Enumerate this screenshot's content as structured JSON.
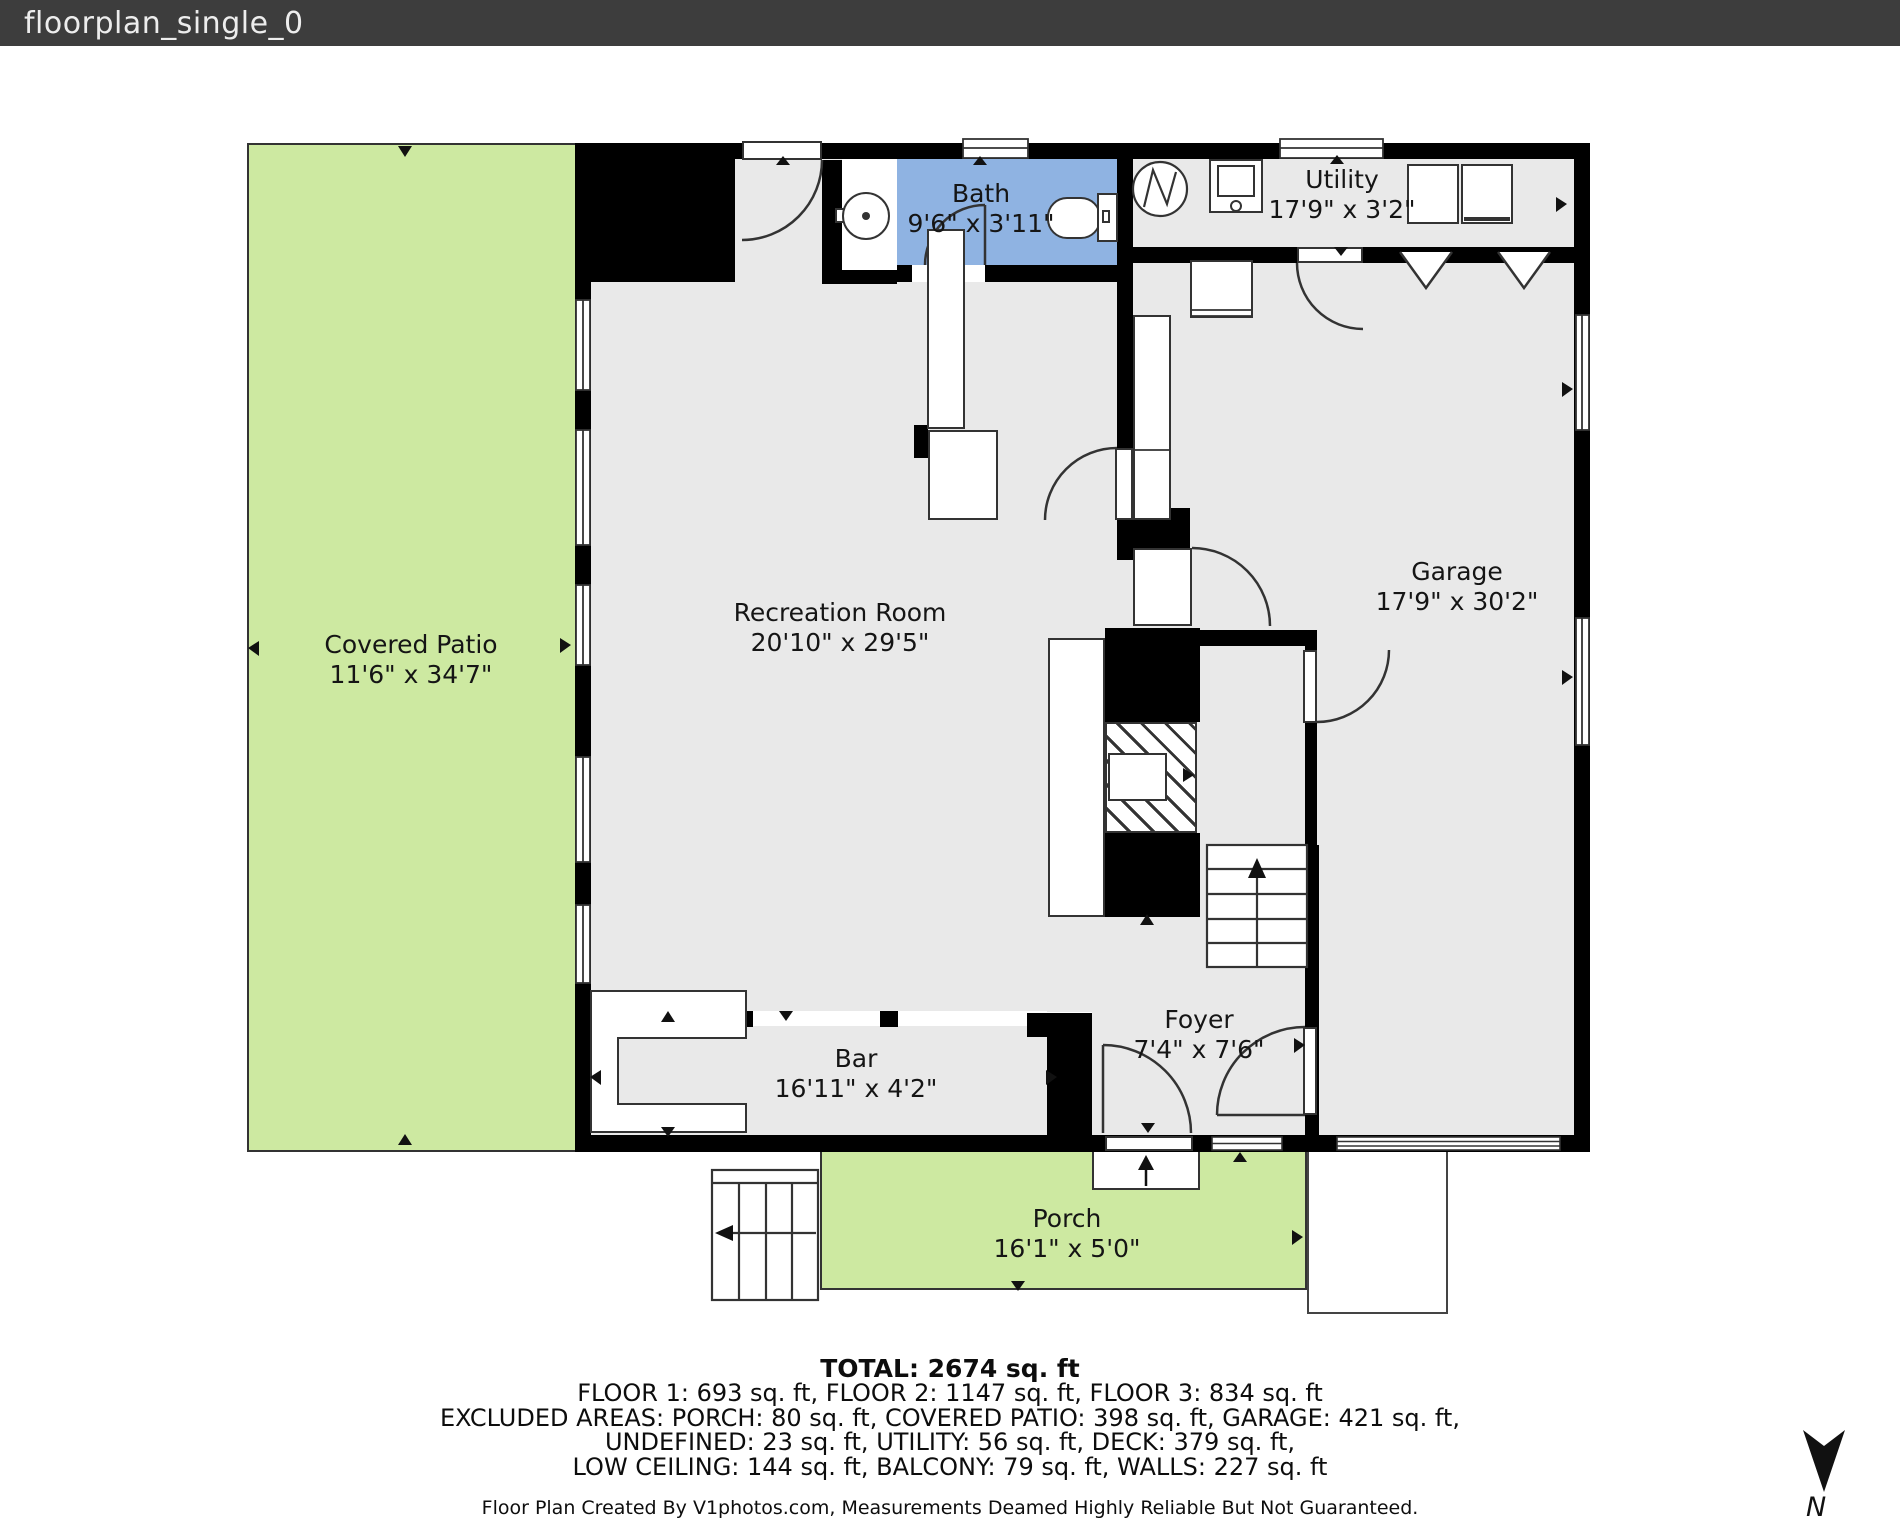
{
  "title_bar": {
    "filename": "floorplan_single_0"
  },
  "rooms": {
    "covered_patio": {
      "name": "Covered Patio",
      "dims": "11'6\" x 34'7\""
    },
    "bath": {
      "name": "Bath",
      "dims": "9'6\" x 3'11\""
    },
    "utility": {
      "name": "Utility",
      "dims": "17'9\" x 3'2\""
    },
    "recreation": {
      "name": "Recreation Room",
      "dims": "20'10\" x 29'5\""
    },
    "garage": {
      "name": "Garage",
      "dims": "17'9\" x 30'2\""
    },
    "bar": {
      "name": "Bar",
      "dims": "16'11\" x 4'2\""
    },
    "foyer": {
      "name": "Foyer",
      "dims": "7'4\" x 7'6\""
    },
    "porch": {
      "name": "Porch",
      "dims": "16'1\" x 5'0\""
    }
  },
  "summary": {
    "total": "TOTAL: 2674 sq. ft",
    "floors": "FLOOR 1: 693 sq. ft, FLOOR 2: 1147 sq. ft, FLOOR 3: 834 sq. ft",
    "excluded_1": "EXCLUDED AREAS: PORCH: 80 sq. ft, COVERED PATIO: 398 sq. ft, GARAGE: 421 sq. ft,",
    "excluded_2": "UNDEFINED: 23 sq. ft, UTILITY: 56 sq. ft, DECK: 379 sq. ft,",
    "excluded_3": "LOW CEILING: 144 sq. ft, BALCONY: 79 sq. ft, WALLS: 227 sq. ft",
    "disclaimer": "Floor Plan Created By V1photos.com, Measurements Deamed Highly Reliable But Not Guaranteed."
  },
  "compass": {
    "label": "N"
  },
  "colors": {
    "titlebar": "#3d3d3d",
    "wall": "#000000",
    "room_gray": "#e9e9e9",
    "patio_green": "#cde9a1",
    "bath_blue": "#8fb3e2",
    "line": "#333333"
  }
}
